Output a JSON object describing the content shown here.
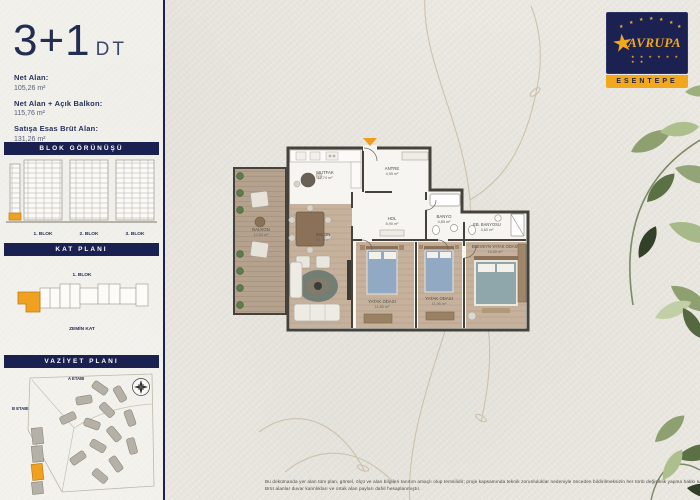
{
  "page": {
    "unit_type": "3+1",
    "unit_code": "DT",
    "area_specs": [
      {
        "label": "Net Alan:",
        "value": "105,26 m²"
      },
      {
        "label": "Net Alan + Açık Balkon:",
        "value": "115,76 m²"
      },
      {
        "label": "Satışa Esas Brüt Alan:",
        "value": "131,26 m²"
      }
    ]
  },
  "sidebar": {
    "block_section": {
      "title": "BLOK GÖRÜNÜŞÜ",
      "block_labels": [
        "1. BLOK",
        "2. BLOK",
        "3. BLOK"
      ]
    },
    "floor_section": {
      "title": "KAT PLANI",
      "block_label": "1. BLOK",
      "floor_label": "ZEMİN KAT"
    },
    "site_section": {
      "title": "VAZİYET PLANI",
      "phase_labels": [
        "A ETABI",
        "B ETABI"
      ]
    }
  },
  "floor_plan": {
    "rooms": [
      {
        "name": "BALKON",
        "area": "10,50 m²"
      },
      {
        "name": "MUTFAK",
        "area": "12,74 m²"
      },
      {
        "name": "ANTRE",
        "area": "4,95 m²"
      },
      {
        "name": "HOL",
        "area": "8,90 m²"
      },
      {
        "name": "BANYO",
        "area": "4,85 m²"
      },
      {
        "name": "SALON",
        "area": "28,40 m²"
      },
      {
        "name": "YATAK ODASI",
        "area": "11,80 m²"
      },
      {
        "name": "YATAK ODASI",
        "area": "11,95 m²"
      },
      {
        "name": "EBEVEYN YATAK ODASI",
        "area": "15,60 m²"
      },
      {
        "name": "EB. BANYOSU",
        "area": "4,60 m²"
      }
    ]
  },
  "logo": {
    "brand": "AVRUPA",
    "location": "ESENTEPE",
    "star_glyph": "★"
  },
  "footer": {
    "line1": "Bu dokümanda yer alan tüm plan, görsel, ölçü ve alan bilgileri tanıtım amaçlı olup temsilidir; proje kapsamında teknik zorunluluklar nedeniyle önceden bildirilmeksizin her türlü değişiklik yapma hakkı saklıdır.",
    "line2": "Brüt alanlar duvar kalınlıkları ve ortak alan payları dahil hesaplanmıştır."
  },
  "colors": {
    "navy": "#1b2150",
    "accent_orange": "#f0a122",
    "wall": "#45423c"
  }
}
